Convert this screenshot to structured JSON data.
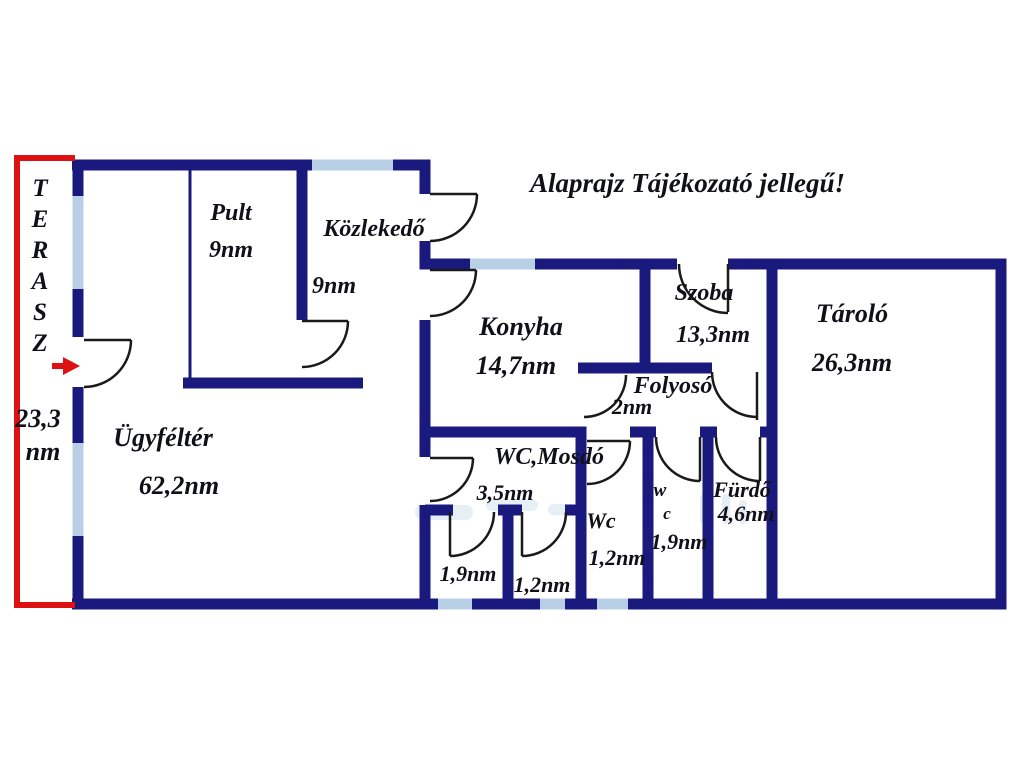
{
  "title": "Alaprajz Tájékozató jellegű!",
  "terrace": {
    "name_letters": [
      "T",
      "E",
      "R",
      "A",
      "S",
      "Z"
    ],
    "area_line1": "23,3",
    "area_line2": "nm"
  },
  "rooms": {
    "pult": {
      "name": "Pult",
      "area": "9nm"
    },
    "kozlekedo": {
      "name": "Közlekedő",
      "area": "9nm"
    },
    "ugyfelter": {
      "name": "Ügyféltér",
      "area": "62,2nm"
    },
    "konyha": {
      "name": "Konyha",
      "area": "14,7nm"
    },
    "szoba": {
      "name": "Szoba",
      "area": "13,3nm"
    },
    "folyoso": {
      "name": "Folyosó",
      "area": "2nm"
    },
    "tarolo": {
      "name": "Tároló",
      "area": "26,3nm"
    },
    "wc_mosdo": {
      "name": "WC,Mosdó",
      "area": "3,5nm"
    },
    "cell_left": {
      "area": "1,9nm"
    },
    "cell_mid": {
      "area": "1,2nm"
    },
    "wc_small": {
      "name": "Wc",
      "area": "1,2nm"
    },
    "wc_tiny": {
      "name_line1": "w",
      "name_line2": "c",
      "area": "1,9nm"
    },
    "furdo": {
      "name": "Fürdő",
      "area": "4,6nm"
    }
  },
  "colors": {
    "wall": "#1a1a7e",
    "window": "#b8cfe6",
    "terrace_outline": "#dd1111",
    "door": "#1a1a1a",
    "label": "#101018",
    "watermark": "#a9c6e2"
  }
}
